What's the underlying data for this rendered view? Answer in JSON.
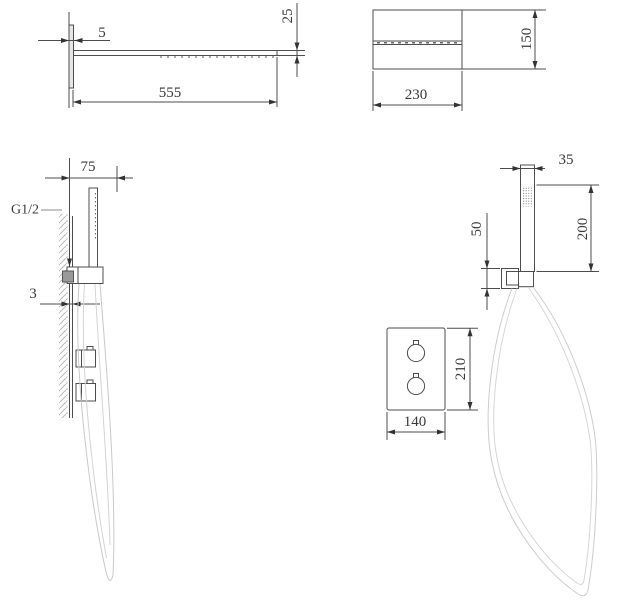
{
  "figures": {
    "overhead_shower_side": {
      "dims": {
        "wall_offset": "5",
        "length": "555",
        "thickness": "25"
      }
    },
    "overhead_shower_front": {
      "dims": {
        "width": "230",
        "height": "150"
      }
    },
    "hand_shower_side": {
      "dims": {
        "wall_distance": "75",
        "plate_thickness": "3"
      },
      "labels": {
        "thread": "G1/2"
      }
    },
    "hand_shower_front": {
      "dims": {
        "width": "35",
        "length": "200",
        "bracket_height": "50"
      }
    },
    "mixer_panel_front": {
      "dims": {
        "width": "140",
        "height": "210"
      }
    }
  },
  "colors": {
    "line": "#4d4d4d",
    "dim_text": "#3a3a3a",
    "hose": "#cccccc",
    "hatch": "#b9b9b9"
  }
}
